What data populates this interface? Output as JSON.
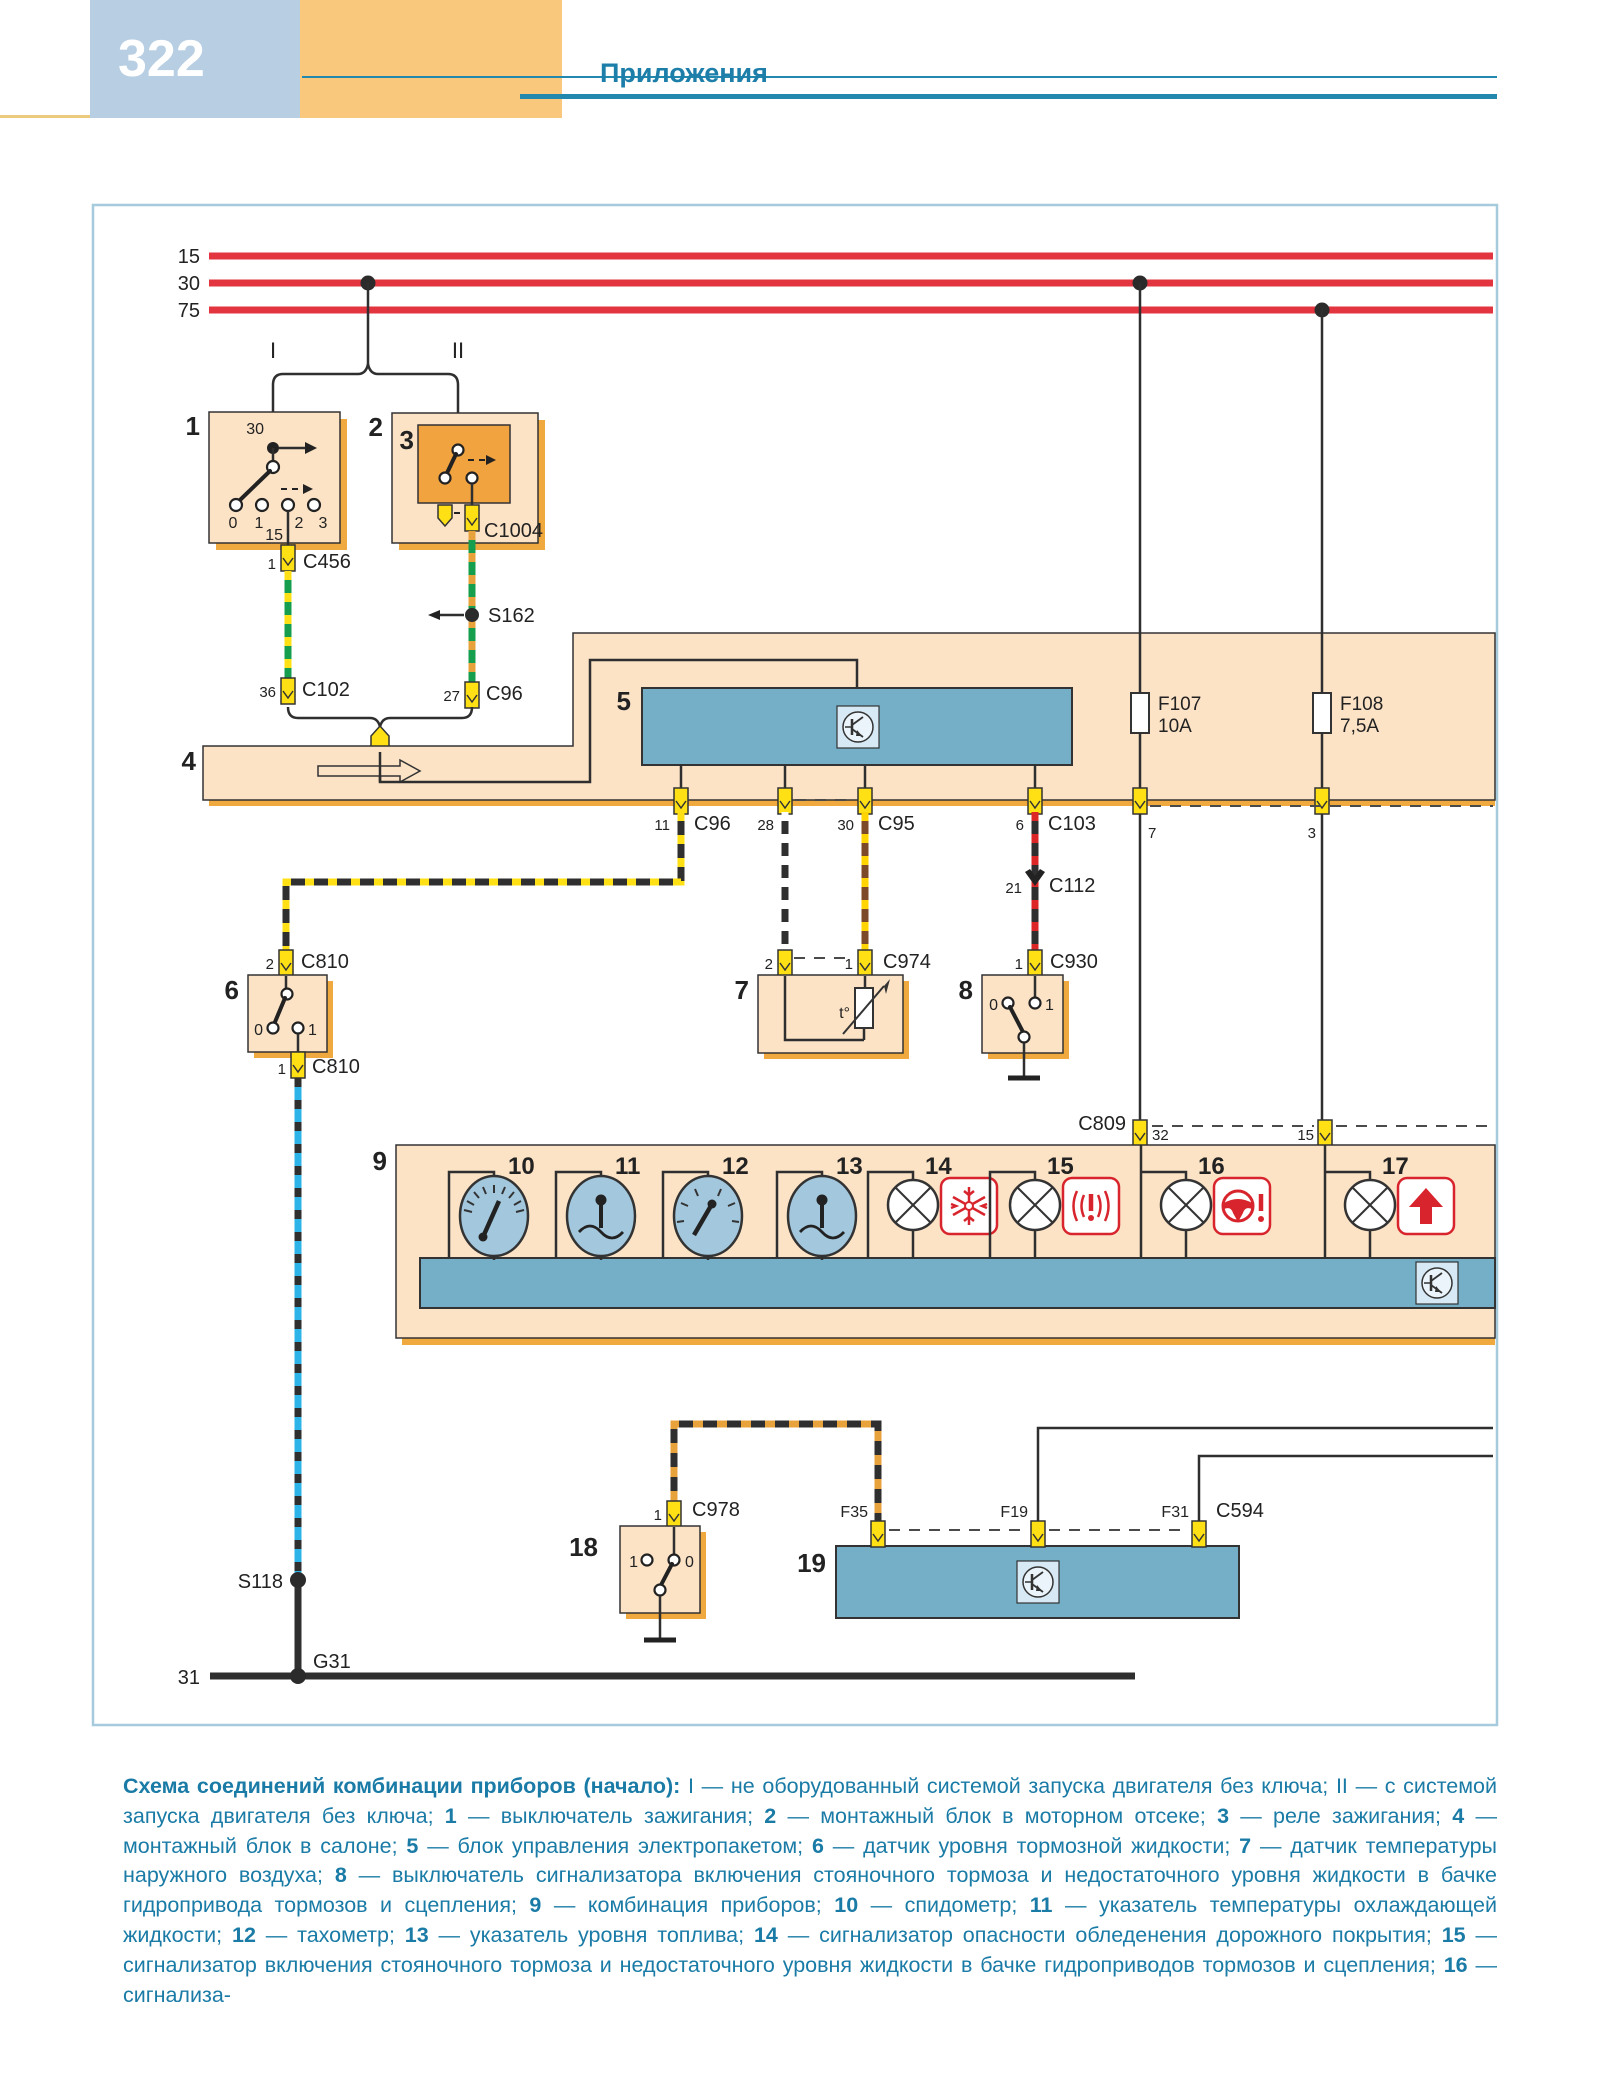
{
  "page": {
    "number": "322",
    "section_title": "Приложения"
  },
  "colors": {
    "header_blue": "#b7cee3",
    "header_orange": "#fac87c",
    "accent_teal": "#1d7fa9",
    "bus_red": "#e23540",
    "component_beige": "#fce3c6",
    "component_shadow": "#efa93f",
    "block_blue": "#74aec7",
    "connector_yellow": "#ffe014",
    "warn_red": "#d8242c"
  },
  "labels": {
    "bus_15": "15",
    "bus_30": "30",
    "bus_75": "75",
    "branch_i": "I",
    "branch_ii": "II",
    "comp_1": "1",
    "comp_2": "2",
    "comp_3": "3",
    "comp_4": "4",
    "comp_5": "5",
    "comp_6": "6",
    "comp_7": "7",
    "comp_8": "8",
    "comp_9": "9",
    "comp_10": "10",
    "comp_11": "11",
    "comp_12": "12",
    "comp_13": "13",
    "comp_14": "14",
    "comp_15": "15",
    "comp_16": "16",
    "comp_17": "17",
    "comp_18": "18",
    "comp_19": "19",
    "sw1_top": "30",
    "sw1_bottom": "15",
    "sw1_p0": "0",
    "sw1_p1": "1",
    "sw1_p2": "2",
    "sw1_p3": "3",
    "c1004": "C1004",
    "c456_pin": "1",
    "c456": "C456",
    "c102_pin": "36",
    "c102": "C102",
    "c96_top_pin": "27",
    "c96_top": "C96",
    "s162": "S162",
    "c96_pin": "11",
    "c96": "C96",
    "pin_28": "28",
    "c95_pin": "30",
    "c95": "C95",
    "c103_pin": "6",
    "c103": "C103",
    "f107": "F107",
    "f107_rating": "10A",
    "f108": "F108",
    "f108_rating": "7,5A",
    "band_pin_7": "7",
    "band_pin_3": "3",
    "c112_pin": "21",
    "c112": "C112",
    "c930_pin": "1",
    "c930": "C930",
    "c974_pin_2": "2",
    "c974_pin_1": "1",
    "c974": "C974",
    "c810_top_pin": "2",
    "c810_top": "C810",
    "c810_bottom_pin": "1",
    "c810_bottom": "C810",
    "sw6_0": "0",
    "sw6_1": "1",
    "temp": "t°",
    "sw8_0": "0",
    "sw8_1": "1",
    "c809": "C809",
    "c809_pin_32": "32",
    "c809_pin_15": "15",
    "sw18_1": "1",
    "sw18_0": "0",
    "c978_pin": "1",
    "c978": "C978",
    "f35": "F35",
    "f19": "F19",
    "f31": "F31",
    "c594": "C594",
    "s118": "S118",
    "g31": "G31",
    "gnd_31": "31"
  },
  "caption": {
    "segments": [
      {
        "t": "Схема соединений комбинации приборов (начало): ",
        "b": true
      },
      {
        "t": "I — не оборудованный системой запуска двигателя без ключа; II — с системой запуска двигателя без ключа; ",
        "b": false
      },
      {
        "t": "1",
        "b": true
      },
      {
        "t": " — выключатель зажигания; ",
        "b": false
      },
      {
        "t": "2",
        "b": true
      },
      {
        "t": " — монтажный блок в моторном отсеке; ",
        "b": false
      },
      {
        "t": "3",
        "b": true
      },
      {
        "t": " — реле зажигания; ",
        "b": false
      },
      {
        "t": "4",
        "b": true
      },
      {
        "t": " — монтажный блок в салоне; ",
        "b": false
      },
      {
        "t": "5",
        "b": true
      },
      {
        "t": " — блок управления электропакетом; ",
        "b": false
      },
      {
        "t": "6",
        "b": true
      },
      {
        "t": " — датчик уровня тормозной жидкости; ",
        "b": false
      },
      {
        "t": "7",
        "b": true
      },
      {
        "t": " — датчик температуры наружного воздуха; ",
        "b": false
      },
      {
        "t": "8",
        "b": true
      },
      {
        "t": " — выключатель сигнализатора включения стояночного тормоза и недостаточного уровня жидкости в бачке гидропривода тормозов и сцепления; ",
        "b": false
      },
      {
        "t": "9",
        "b": true
      },
      {
        "t": " — комбинация приборов; ",
        "b": false
      },
      {
        "t": "10",
        "b": true
      },
      {
        "t": " — спидометр; ",
        "b": false
      },
      {
        "t": "11",
        "b": true
      },
      {
        "t": " — указатель температуры охлаждающей жидкости; ",
        "b": false
      },
      {
        "t": "12",
        "b": true
      },
      {
        "t": " — тахометр; ",
        "b": false
      },
      {
        "t": "13",
        "b": true
      },
      {
        "t": " — указатель уровня топлива; ",
        "b": false
      },
      {
        "t": "14",
        "b": true
      },
      {
        "t": " — сигнализатор опасности обледенения дорожного покрытия; ",
        "b": false
      },
      {
        "t": "15",
        "b": true
      },
      {
        "t": " — сигнализатор включения стояночного тормоза и недостаточного уровня жидкости в бачке гидроприводов тормозов и сцепления; ",
        "b": false
      },
      {
        "t": "16",
        "b": true
      },
      {
        "t": " — сигнализа-",
        "b": false
      }
    ]
  }
}
